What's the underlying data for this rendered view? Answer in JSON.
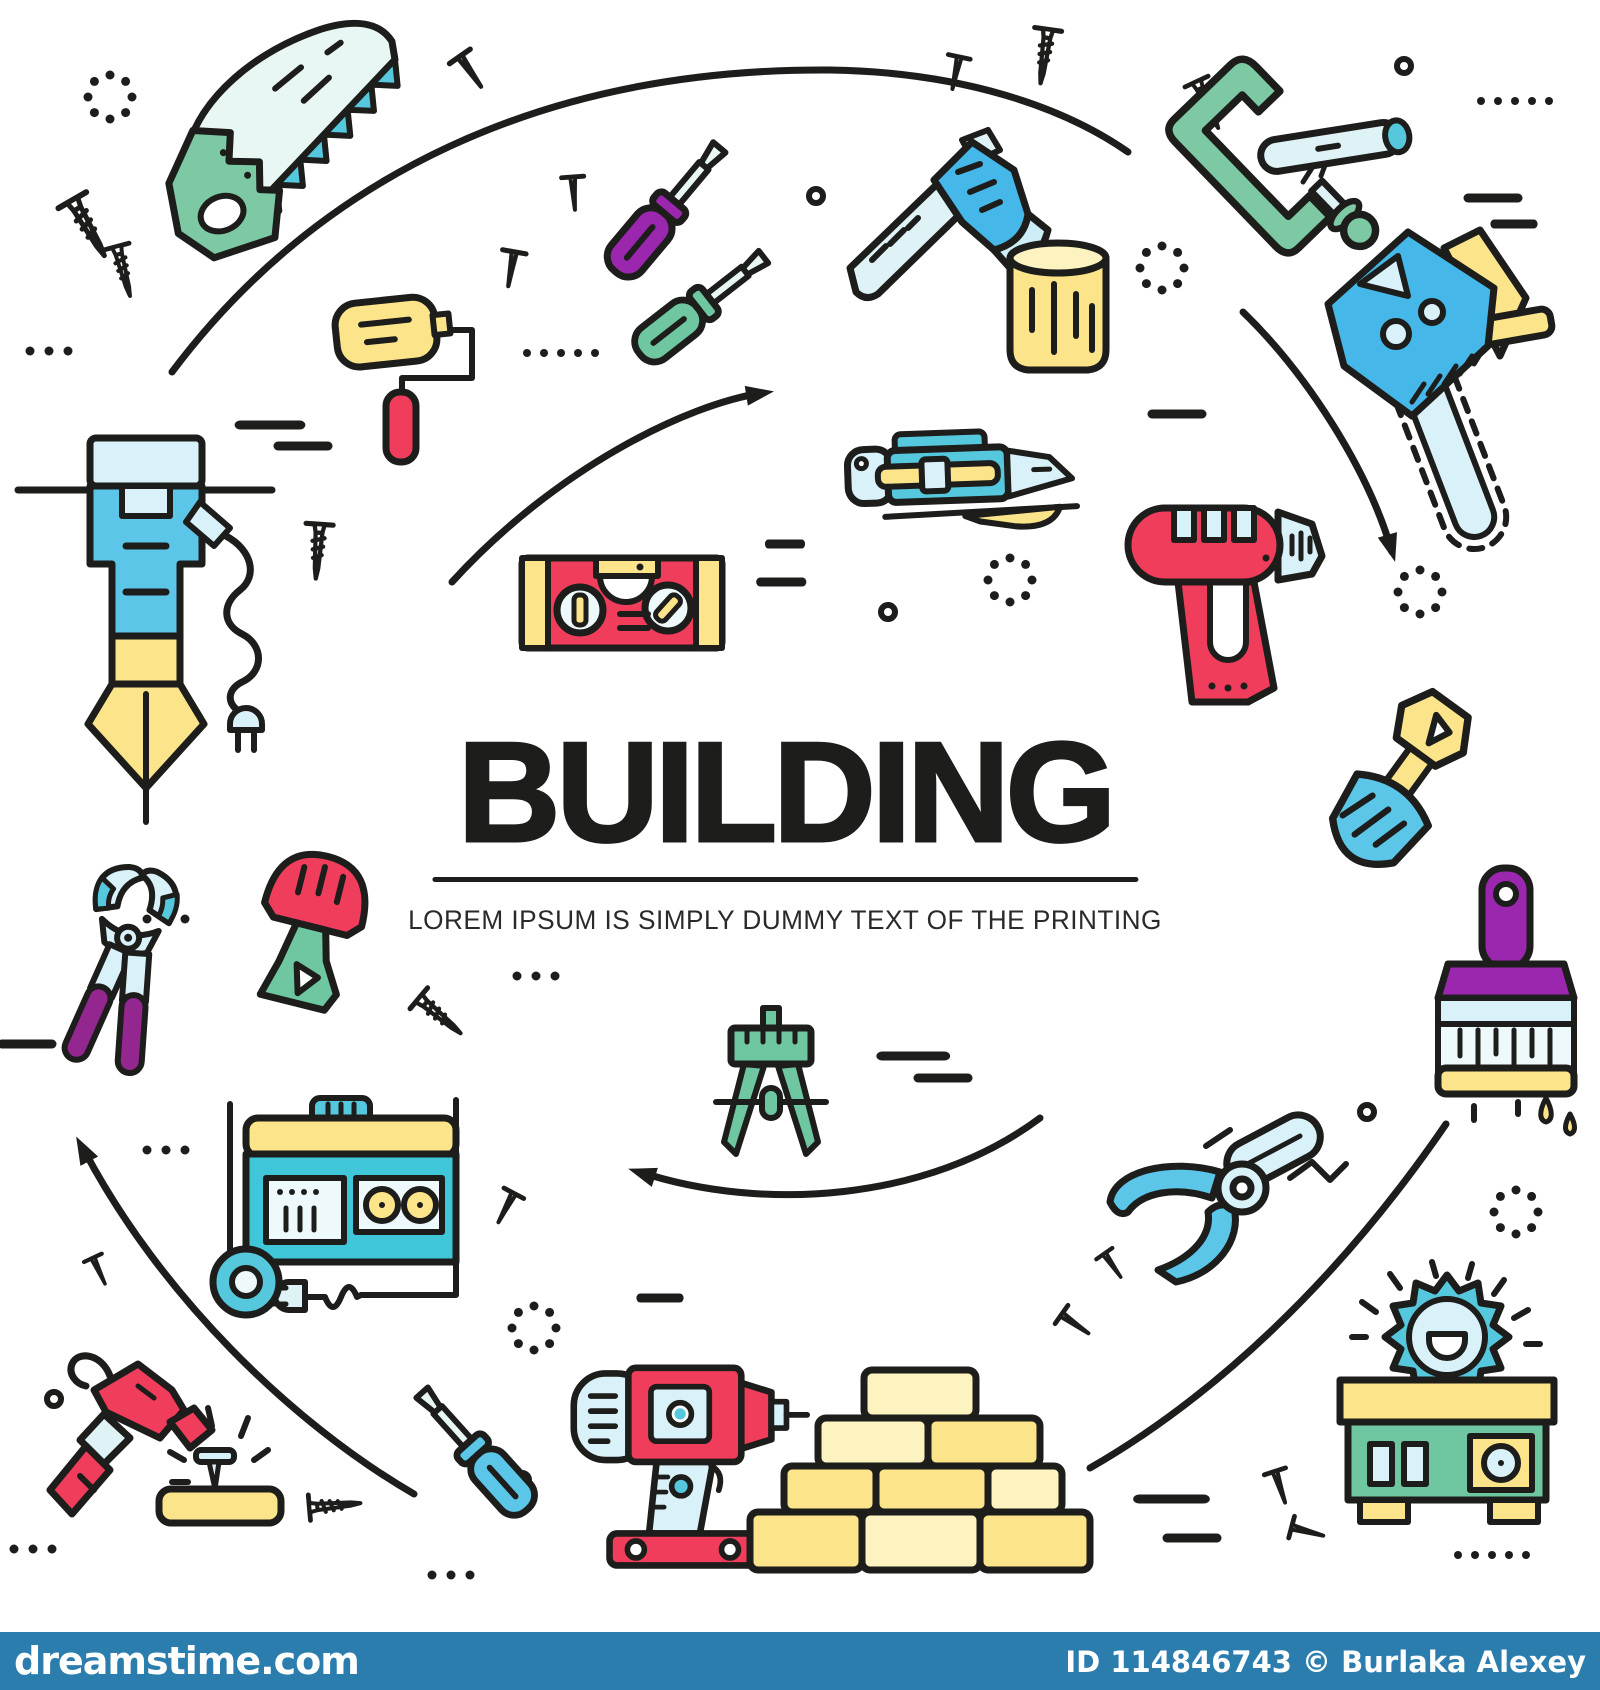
{
  "poster": {
    "title": "BUILDING",
    "subtitle": "LOREM IPSUM IS SIMPLY DUMMY TEXT OF THE PRINTING"
  },
  "watermark_bar": {
    "site": "dreamstime.com",
    "credit": "ID 114846743 © Burlaka  Alexey",
    "bar_color": "#2b7dad",
    "text_color": "#ffffff"
  },
  "palette": {
    "outline": "#1d1d1b",
    "red": "#ef3d5b",
    "yellow": "#fbe48a",
    "pale_yellow": "#fdf3c0",
    "blue": "#45b7e8",
    "sky_blue": "#5bc6e8",
    "teal": "#56c8dd",
    "pale_blue": "#d9f1f8",
    "green": "#7dc9a4",
    "mint": "#6fc7a2",
    "purple": "#93278f",
    "violet": "#9b27af"
  },
  "icons": [
    "handsaw",
    "screwdriver-purple",
    "screwdriver-green",
    "axe",
    "wood-log",
    "c-clamp",
    "pipe-in-clamp",
    "chainsaw",
    "paint-roller",
    "jackhammer",
    "utility-knife",
    "spirit-level",
    "heat-gun",
    "shovel",
    "pliers",
    "trowel",
    "generator",
    "compass-divider",
    "pruning-shears",
    "paintbrush",
    "hammer",
    "nail-and-board",
    "screwdriver-blue",
    "power-drill",
    "bricks",
    "table-saw"
  ],
  "decorations": [
    "screws",
    "nails",
    "arcs",
    "arrows",
    "dash-marks",
    "dot-rows",
    "dotted-circles",
    "ring-dots"
  ]
}
